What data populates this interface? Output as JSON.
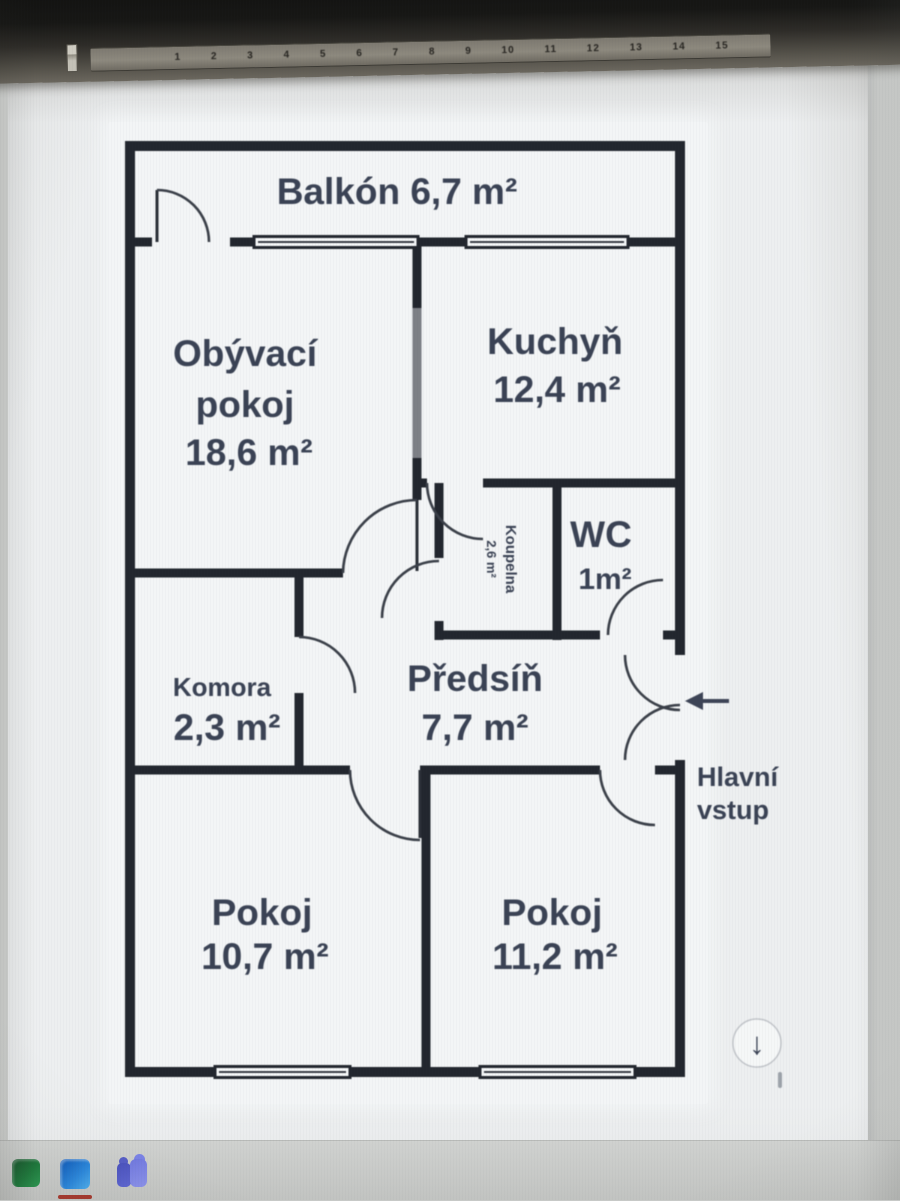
{
  "floorplan": {
    "balcony": {
      "label": "Balkón   6,7 m²"
    },
    "living": {
      "name1": "Obývací",
      "name2": "pokoj",
      "area": "18,6 m²"
    },
    "kitchen": {
      "name": "Kuchyň",
      "area": "12,4 m²"
    },
    "bathroom": {
      "name": "Koupelna",
      "area": "2,6 m²"
    },
    "wc": {
      "name": "WC",
      "area": "1m²"
    },
    "komora": {
      "name": "Komora",
      "area": "2,3 m²"
    },
    "hall": {
      "name": "Předsíň",
      "area": "7,7 m²"
    },
    "room1": {
      "name": "Pokoj",
      "area": "10,7 m²"
    },
    "room2": {
      "name": "Pokoj",
      "area": "11,2 m²"
    },
    "entrance": {
      "line1": "Hlavní",
      "line2": "vstup",
      "arrow_glyph": "←"
    }
  },
  "ruler": {
    "numbers_text": "1 2 3 4 5 6 7 8 9 10 11 12 13 14 15"
  },
  "taskbar": {
    "icons": [
      {
        "name": "excel-app-icon",
        "color": "#1d7a3c"
      },
      {
        "name": "word-app-icon",
        "color": "#2b8ae0",
        "active_underline_color": "#a8392e"
      },
      {
        "name": "teams-app-icon",
        "color": "#7179e2"
      }
    ]
  },
  "scroll": {
    "down_glyph": "↓"
  }
}
